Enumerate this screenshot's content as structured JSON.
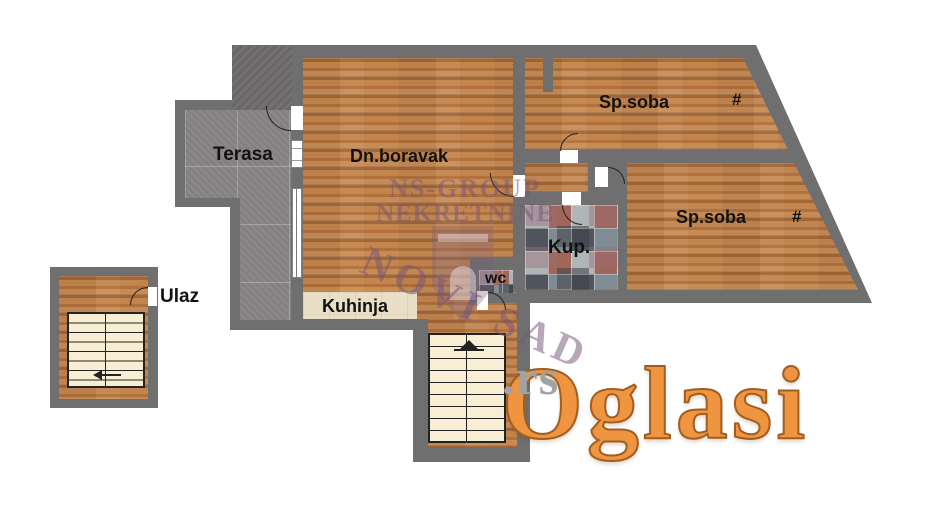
{
  "rooms": {
    "terasa": {
      "label": "Terasa"
    },
    "living": {
      "label": "Dn.boravak"
    },
    "bedroom_top": {
      "label": "Sp.soba",
      "mark": "#"
    },
    "bedroom_right": {
      "label": "Sp.soba",
      "mark": "#"
    },
    "bathroom": {
      "label": "Kup."
    },
    "wc": {
      "label": "wc"
    },
    "kitchen": {
      "label": "Kuhinja"
    },
    "entrance": {
      "label": "Ulaz"
    }
  },
  "watermark": {
    "agency_line1": "NS-GROUP",
    "agency_line2": "NEKRETNINE",
    "city": "NOVI SAD"
  },
  "logo": {
    "brand": "Oglasi",
    "tld": ".rs"
  },
  "colors": {
    "wall_gray": "#6f6f70",
    "wood_floor": "#b97a45",
    "terrace_gray": "#8b8688",
    "kitchen_beige": "#e9dfc7",
    "stairs_cream": "#f7eed3",
    "tile_slate": "#7d8a92",
    "tile_brick": "#a35b4c",
    "watermark_purple": "#7b5c82",
    "logo_orange": "#ef9440",
    "logo_gray": "#a2a2a2"
  }
}
